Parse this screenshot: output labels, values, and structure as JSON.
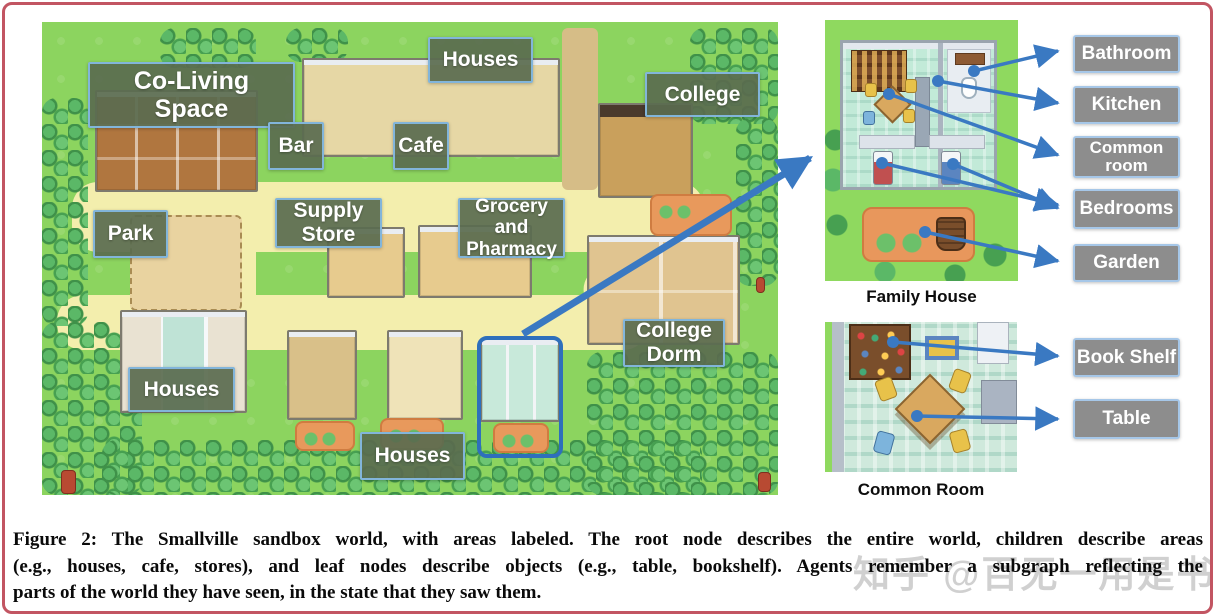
{
  "map": {
    "labels": [
      {
        "id": "co-living-space",
        "text": "Co-Living Space"
      },
      {
        "id": "houses-top",
        "text": "Houses"
      },
      {
        "id": "college",
        "text": "College"
      },
      {
        "id": "bar",
        "text": "Bar"
      },
      {
        "id": "cafe",
        "text": "Cafe"
      },
      {
        "id": "supply-store",
        "text": "Supply Store"
      },
      {
        "id": "grocery-pharmacy",
        "text": "Grocery and Pharmacy"
      },
      {
        "id": "park",
        "text": "Park"
      },
      {
        "id": "houses-left",
        "text": "Houses"
      },
      {
        "id": "college-dorm",
        "text": "College Dorm"
      },
      {
        "id": "houses-bottom",
        "text": "Houses"
      }
    ]
  },
  "insets": {
    "family_house": {
      "caption": "Family House",
      "labels": [
        "Bathroom",
        "Kitchen",
        "Common room",
        "Bedrooms",
        "Garden"
      ]
    },
    "common_room": {
      "caption": "Common Room",
      "labels": [
        "Book Shelf",
        "Table"
      ]
    }
  },
  "caption": {
    "lines": [
      "Figure 2: The Smallville sandbox world, with areas labeled. The root node describes the entire world, children describe areas",
      "(e.g., houses, cafe, stores), and leaf nodes describe objects (e.g., table, bookshelf). Agents remember a subgraph reflecting the",
      "parts of the world they have seen, in the state that they saw them."
    ]
  },
  "watermark": "知乎 @百无一用是书生",
  "colors": {
    "frame_border": "#c25562",
    "map_label_bg": "#5a6b4f",
    "map_label_border": "#82b5da",
    "side_label_bg": "#8d8d8d",
    "side_label_border": "#a6c7e8",
    "arrow_blue": "#3a79c2",
    "highlight_blue": "#2e6fbc",
    "grass_green": "#8cd45f",
    "path_yellow": "#f3eead"
  }
}
